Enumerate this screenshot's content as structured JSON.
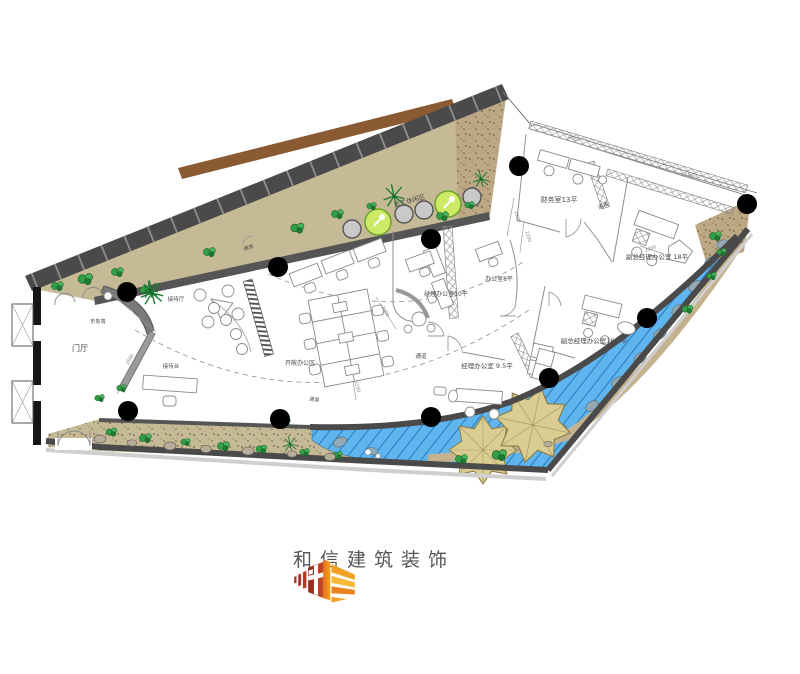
{
  "page": {
    "background": "#ffffff"
  },
  "logo": {
    "text": "和信建筑装饰",
    "colors": {
      "dark_red": "#8f241d",
      "red": "#c84a22",
      "orange": "#e8831f",
      "amber": "#f0a125",
      "yellow": "#f6b93c",
      "text": "#56565a"
    }
  },
  "plan": {
    "colors": {
      "wall": "#4a4a4a",
      "terrace": "#c6ba96",
      "gravel": "#bda886",
      "deck_plank": "#8a5a33",
      "water": "#5fb6ef",
      "water_hatch": "#2e7cc0",
      "leaf_island": "#dacd92",
      "plant": "#2f9e44",
      "leisure_table": "#cdea67",
      "column": "#000000",
      "line": "#8f8f8f"
    },
    "labels": [
      {
        "text": "门厅",
        "x": 80,
        "y": 351,
        "size": 8,
        "rot": 0
      },
      {
        "text": "形象墙",
        "x": 98,
        "y": 323,
        "size": 5,
        "rot": 0
      },
      {
        "text": "接待厅",
        "x": 176,
        "y": 301,
        "size": 5.5,
        "rot": 0
      },
      {
        "text": "接待台",
        "x": 171,
        "y": 368,
        "size": 5.5,
        "rot": 0
      },
      {
        "text": "开敞办公区",
        "x": 300,
        "y": 365,
        "size": 6,
        "rot": 0
      },
      {
        "text": "员工休闲区",
        "x": 410,
        "y": 203,
        "size": 6.5,
        "rot": -16
      },
      {
        "text": "通道",
        "x": 249,
        "y": 249,
        "size": 5,
        "rot": -20
      },
      {
        "text": "通道",
        "x": 604,
        "y": 207,
        "size": 5.5,
        "rot": -25
      },
      {
        "text": "通道",
        "x": 421,
        "y": 358,
        "size": 5.5,
        "rot": 0
      },
      {
        "text": "通道",
        "x": 314,
        "y": 401,
        "size": 5,
        "rot": 6
      },
      {
        "text": "经理办公室10平",
        "x": 446,
        "y": 296,
        "size": 6,
        "rot": 0
      },
      {
        "text": "办公室8平",
        "x": 499,
        "y": 281,
        "size": 6,
        "rot": 0
      },
      {
        "text": "财务室13平",
        "x": 559,
        "y": 202,
        "size": 7,
        "rot": 0
      },
      {
        "text": "副总经理办公室 18平",
        "x": 657,
        "y": 259,
        "size": 6.5,
        "rot": 0
      },
      {
        "text": "副总经理办公室16.5平",
        "x": 594,
        "y": 343,
        "size": 6.5,
        "rot": 0
      },
      {
        "text": "经理办公室 9.5平",
        "x": 487,
        "y": 368,
        "size": 6.5,
        "rot": 0
      }
    ],
    "dimensions": [
      {
        "text": "3000",
        "x": 126,
        "y": 307,
        "size": 4.5,
        "rot": 42
      },
      {
        "text": "2600",
        "x": 131,
        "y": 360,
        "size": 4.5,
        "rot": -61
      },
      {
        "text": "2800",
        "x": 384,
        "y": 312,
        "size": 4.5,
        "rot": 62
      },
      {
        "text": "1250",
        "x": 356,
        "y": 387,
        "size": 4.5,
        "rot": 73
      },
      {
        "text": "4020",
        "x": 573,
        "y": 140,
        "size": 4.5,
        "rot": 16
      },
      {
        "text": "2900",
        "x": 516,
        "y": 217,
        "size": 4.5,
        "rot": 74
      },
      {
        "text": "4700",
        "x": 689,
        "y": 177,
        "size": 4.5,
        "rot": 17
      },
      {
        "text": "2000",
        "x": 651,
        "y": 250,
        "size": 4.5,
        "rot": -20
      },
      {
        "text": "2200",
        "x": 527,
        "y": 237,
        "size": 4.5,
        "rot": 74
      }
    ],
    "columns": [
      [
        127,
        292
      ],
      [
        278,
        267
      ],
      [
        431,
        239
      ],
      [
        519,
        166
      ],
      [
        747,
        204
      ],
      [
        647,
        318
      ],
      [
        549,
        378
      ],
      [
        431,
        417
      ],
      [
        280,
        419
      ],
      [
        128,
        411
      ]
    ]
  }
}
